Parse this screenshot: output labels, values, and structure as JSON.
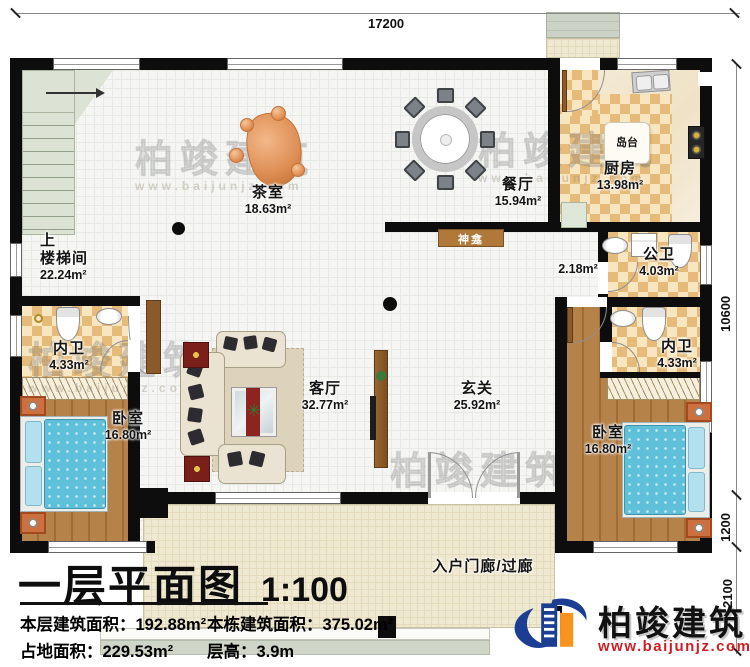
{
  "dims": {
    "top": "17200",
    "right_upper": "10600",
    "right_mid": "1200",
    "right_lower": "2100"
  },
  "rooms": {
    "stair_up": "上",
    "stair_name": "楼梯间",
    "stair_area": "22.24m²",
    "tea_name": "茶室",
    "tea_area": "18.63m²",
    "dining_name": "餐厅",
    "dining_area": "15.94m²",
    "kitchen_name": "厨房",
    "kitchen_area": "13.98m²",
    "island": "岛台",
    "shrine": "神龛",
    "corridor_area": "2.18m²",
    "pubbath_name": "公卫",
    "pubbath_area": "4.03m²",
    "bath_left_name": "内卫",
    "bath_left_area": "4.33m²",
    "bath_right_name": "内卫",
    "bath_right_area": "4.33m²",
    "bedroom_left_name": "卧室",
    "bedroom_left_area": "16.80m²",
    "bedroom_right_name": "卧室",
    "bedroom_right_area": "16.80m²",
    "living_name": "客厅",
    "living_area": "32.77m²",
    "foyer_name": "玄关",
    "foyer_area": "25.92m²",
    "porch_name": "入户门廊/过廊"
  },
  "titleblock": {
    "title": "一层平面图",
    "scale": "1:100",
    "stat1_label": "本层建筑面积：",
    "stat1_value": "192.88m²",
    "stat2_label": "本栋建筑面积：",
    "stat2_value": "375.02m²",
    "stat3_label": "占地面积：",
    "stat3_value": "229.53m²",
    "stat4_label": "层高：",
    "stat4_value": "3.9m"
  },
  "brand": {
    "name": "柏竣建筑",
    "url": "www.baijunjz.com",
    "colors": {
      "blue": "#1b3e92",
      "orange": "#f7941d",
      "red": "#d01f24"
    }
  },
  "watermark": {
    "text": "柏竣建筑",
    "url": "www.baijunjz.com"
  }
}
